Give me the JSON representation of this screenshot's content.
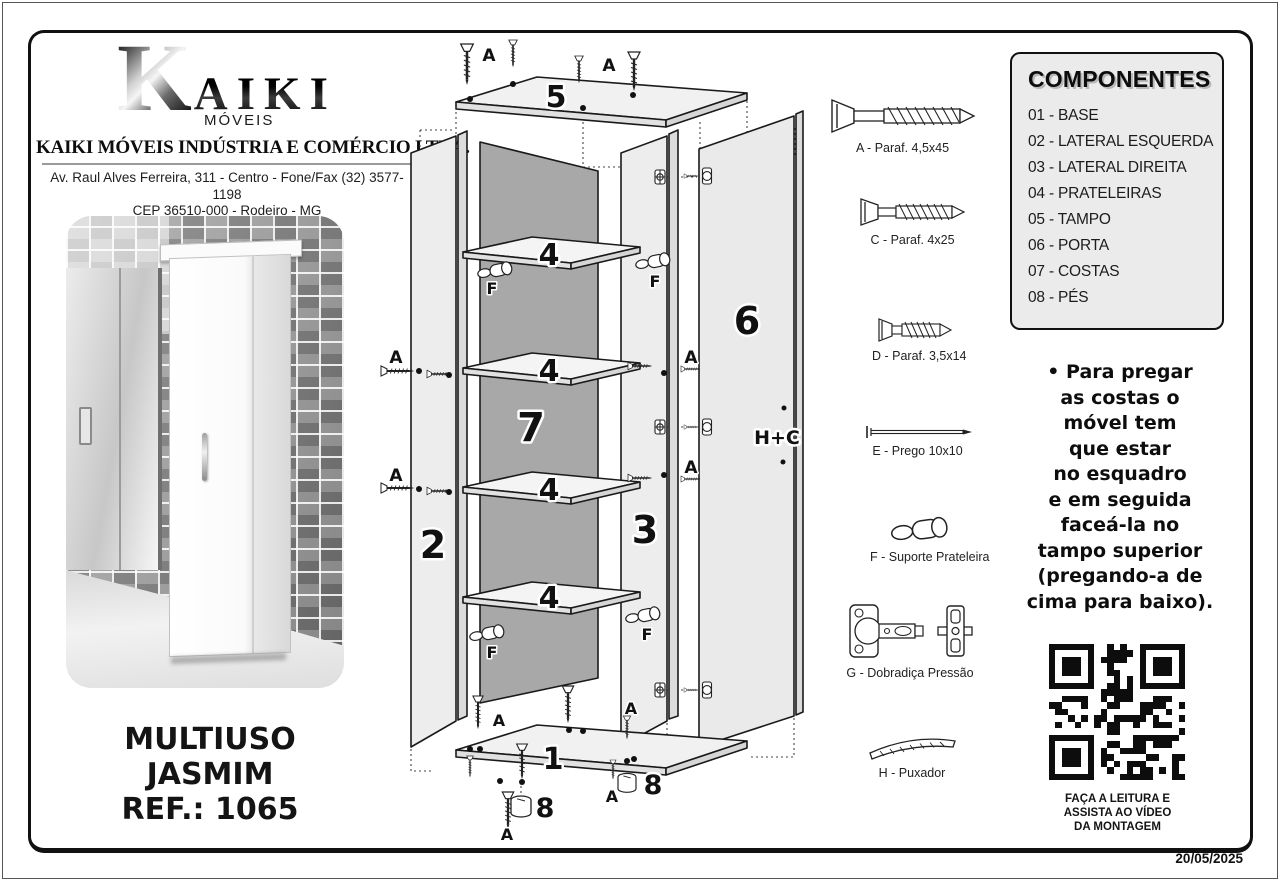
{
  "header": {
    "logo_k": "K",
    "logo_rest": "AIKI",
    "logo_sub": "MÓVEIS",
    "company": "KAIKI MÓVEIS INDÚSTRIA E COMÉRCIO LTDA.",
    "address_line1": "Av. Raul Alves Ferreira, 311 - Centro - Fone/Fax (32) 3577-1198",
    "address_line2": "CEP 36510-000 - Rodeiro - MG",
    "email": "vendas@kaikimoveis.com.br"
  },
  "product": {
    "title": "MULTIUSO\nJASMIM\nREF.: 1065"
  },
  "components": {
    "title": "COMPONENTES",
    "items": [
      "01 -  BASE",
      "02 -  LATERAL ESQUERDA",
      "03 -  LATERAL DIREITA",
      "04 -  PRATELEIRAS",
      "05 -  TAMPO",
      "06 -  PORTA",
      "07 -  COSTAS",
      "08 -  PÉS"
    ]
  },
  "hardware": [
    {
      "label": "A - Paraf. 4,5x45",
      "icon": "screw-long"
    },
    {
      "label": "C - Paraf. 4x25",
      "icon": "screw-medium"
    },
    {
      "label": "D - Paraf. 3,5x14",
      "icon": "screw-short"
    },
    {
      "label": "E - Prego 10x10",
      "icon": "nail"
    },
    {
      "label": "F - Suporte Prateleira",
      "icon": "shelf-support"
    },
    {
      "label": "G - Dobradiça Pressão",
      "icon": "press-hinge"
    },
    {
      "label": "H - Puxador",
      "icon": "handle"
    }
  ],
  "note": "•  Para pregar\nas costas o\nmóvel tem\nque estar\nno esquadro\ne em seguida\nfaceá-la no\ntampo superior\n(pregando-a de\ncima para baixo).",
  "qr": {
    "caption": "FAÇA A LEITURA E\nASSISTA AO VÍDEO\nDA MONTAGEM"
  },
  "footer": {
    "date": "20/05/2025"
  },
  "diagram": {
    "tampo": "5",
    "shelf": "4",
    "back": "7",
    "left_side": "2",
    "right_side": "3",
    "door": "6",
    "base": "1",
    "foot": "8",
    "handle_hinge": "H+C",
    "screw_label": "A",
    "support_label": "F"
  },
  "colors": {
    "panel_face": "#ededed",
    "panel_edge": "#dcdcdc",
    "back_panel": "#a8a8a8",
    "shelf_face": "#f4f4f4",
    "ink": "#111111",
    "box_bg": "#ebebeb"
  }
}
